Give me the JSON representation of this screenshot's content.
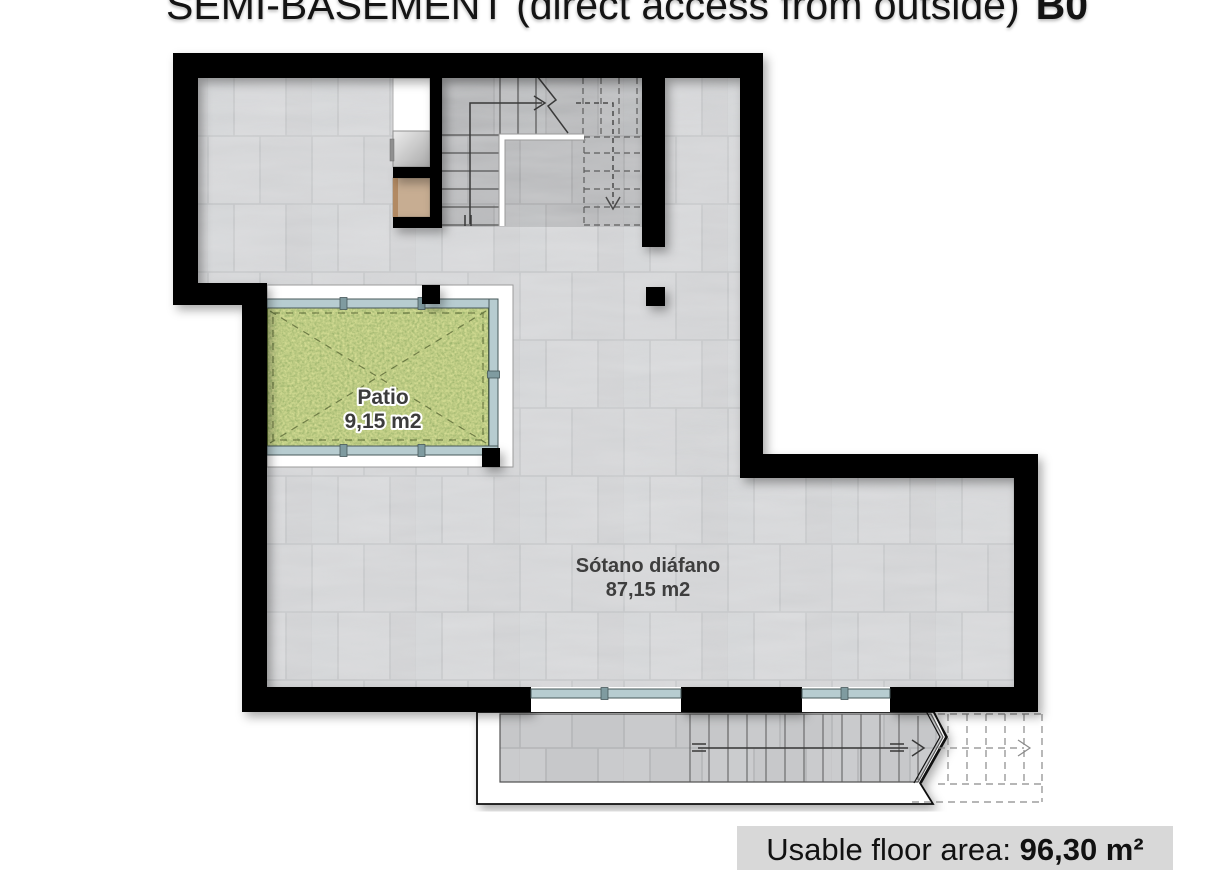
{
  "title": {
    "main": "SEMI-BASEMENT (direct access from outside)",
    "code": "B0"
  },
  "plan": {
    "patio": {
      "name": "Patio",
      "area": "9,15 m2"
    },
    "basement": {
      "name": "Sótano diáfano",
      "area": "87,15 m2"
    }
  },
  "footer": {
    "label": "Usable floor area: ",
    "value": "96,30 m²"
  },
  "colors": {
    "wall": "#000000",
    "floor_tile": "#d1d2d4",
    "stair_tile": "#b2b3b5",
    "exterior_stair_tile": "#c9cacc",
    "grass": "#7f9a40",
    "glazing": "#b7ccd0",
    "fixture_tan": "#c7ad92",
    "walkway": "#ffffff",
    "footer_bg": "#d8d8d8",
    "label_text": "#3e3e3e"
  }
}
